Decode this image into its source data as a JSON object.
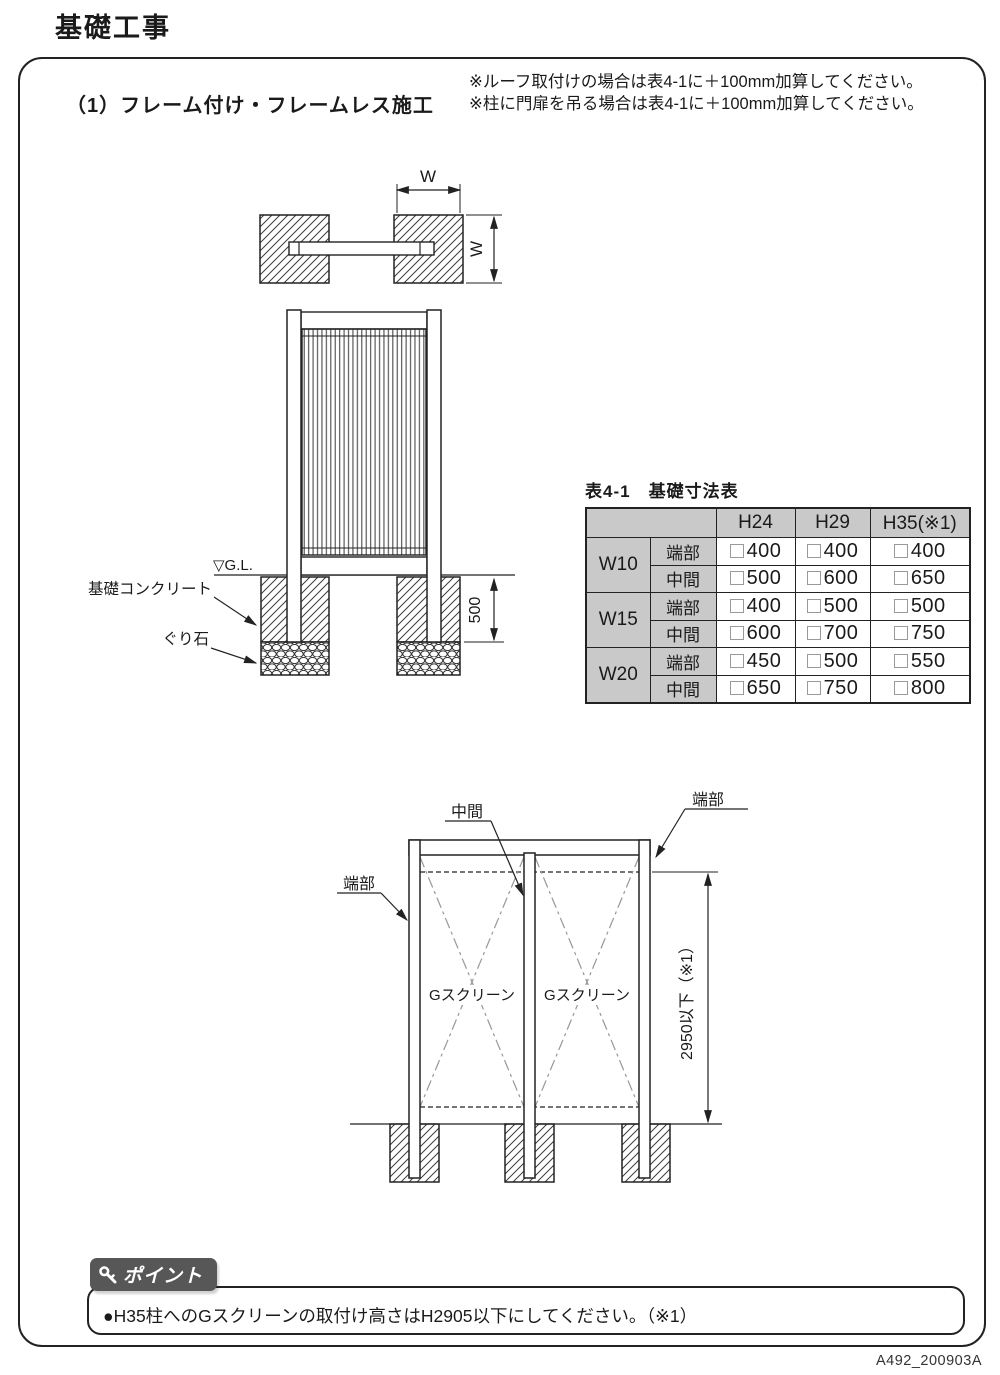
{
  "page": {
    "title": "基礎工事",
    "doc_code": "A492_200903A"
  },
  "section": {
    "heading": "（1）フレーム付け・フレームレス施工",
    "notes": [
      "※ルーフ取付けの場合は表4-1に＋100mm加算してください。",
      "※柱に門扉を吊る場合は表4-1に＋100mm加算してください。"
    ]
  },
  "plan_view": {
    "width_dim_top": "W",
    "width_dim_side": "W"
  },
  "elevation": {
    "ground_label": "▽G.L.",
    "concrete_label": "基礎コンクリート",
    "gravel_label": "ぐり石",
    "depth_dim": "500"
  },
  "table": {
    "title": "表4-1　基礎寸法表",
    "col_headers": [
      "H24",
      "H29",
      "H35(※1)"
    ],
    "rows": [
      {
        "group": "W10",
        "part": "端部",
        "values": [
          "400",
          "400",
          "400"
        ]
      },
      {
        "group": "W10",
        "part": "中間",
        "values": [
          "500",
          "600",
          "650"
        ]
      },
      {
        "group": "W15",
        "part": "端部",
        "values": [
          "400",
          "500",
          "500"
        ]
      },
      {
        "group": "W15",
        "part": "中間",
        "values": [
          "600",
          "700",
          "750"
        ]
      },
      {
        "group": "W20",
        "part": "端部",
        "values": [
          "450",
          "500",
          "550"
        ]
      },
      {
        "group": "W20",
        "part": "中間",
        "values": [
          "650",
          "750",
          "800"
        ]
      }
    ]
  },
  "lower_diagram": {
    "middle_label": "中間",
    "end_label_right": "端部",
    "end_label_left": "端部",
    "panel_labels": [
      "Gスクリーン",
      "Gスクリーン"
    ],
    "height_dim": "2950以下（※1）"
  },
  "point": {
    "badge_label": "ポイント",
    "text": "●H35柱へのGスクリーンの取付け高さはH2905以下にしてください。（※1）"
  }
}
